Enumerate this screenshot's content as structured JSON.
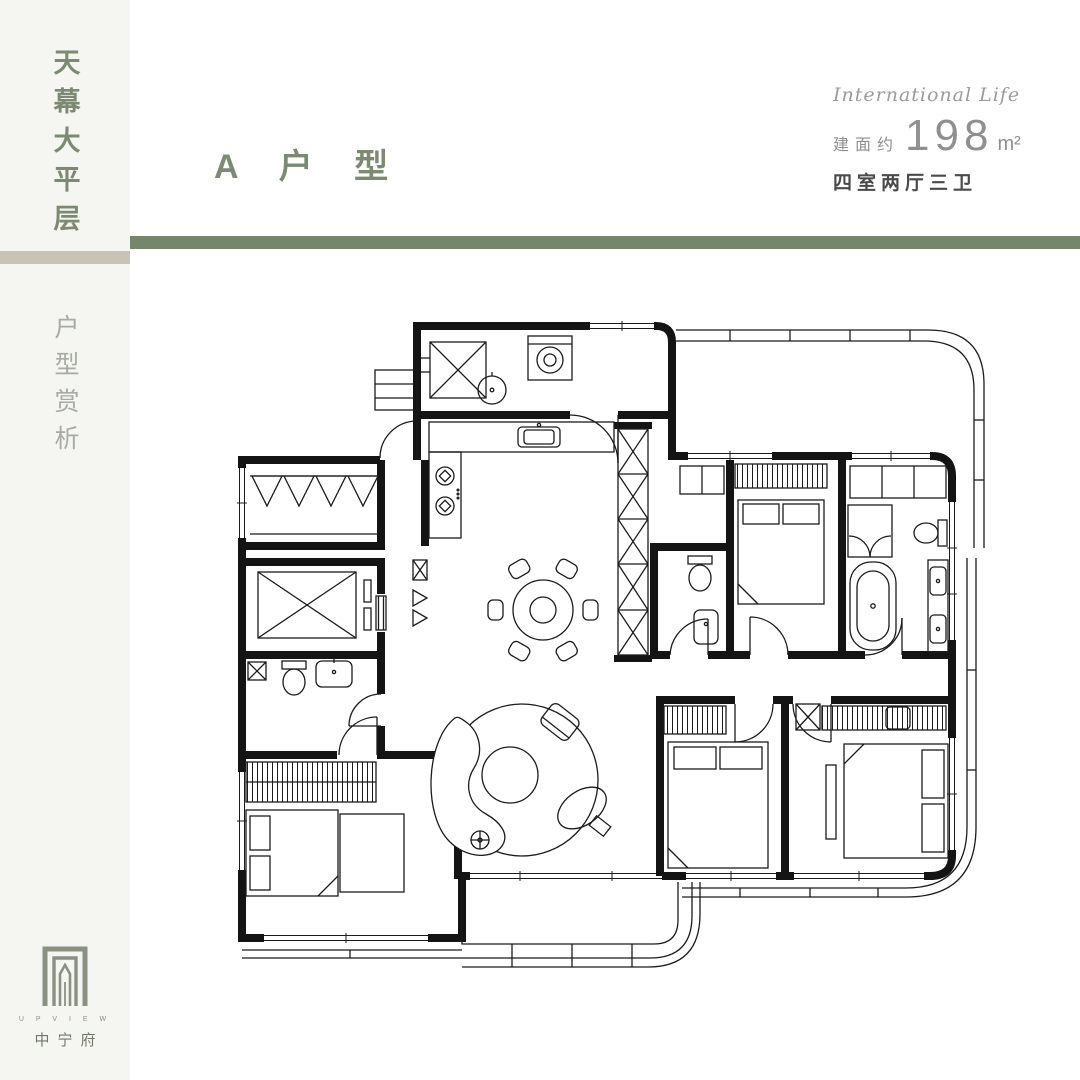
{
  "colors": {
    "page_bg": "#ffffff",
    "sidebar_bg": "#f5f5f2",
    "accent_green": "#75876b",
    "accent_beige": "#c8c3b7",
    "title_green": "#7c8a72",
    "subtitle_gray": "#a6aca2",
    "tagline_gray": "#9b9b9b",
    "area_gray": "#8f8f8f",
    "layout_dark": "#4a4a4a",
    "plan_ink": "#1b1b1b",
    "logo_green": "#8a9183"
  },
  "sidebar": {
    "title_vertical": "天幕大平层",
    "subtitle_vertical": "户型赏析",
    "logo": {
      "brand_en": "U P V I E W",
      "brand_cn": "中宁府"
    }
  },
  "header": {
    "plan_title": "A 户 型",
    "tagline": "International Life",
    "area_label": "建面约",
    "area_value": "198",
    "area_unit": "m²",
    "layout_summary": "四室两厅三卫"
  }
}
